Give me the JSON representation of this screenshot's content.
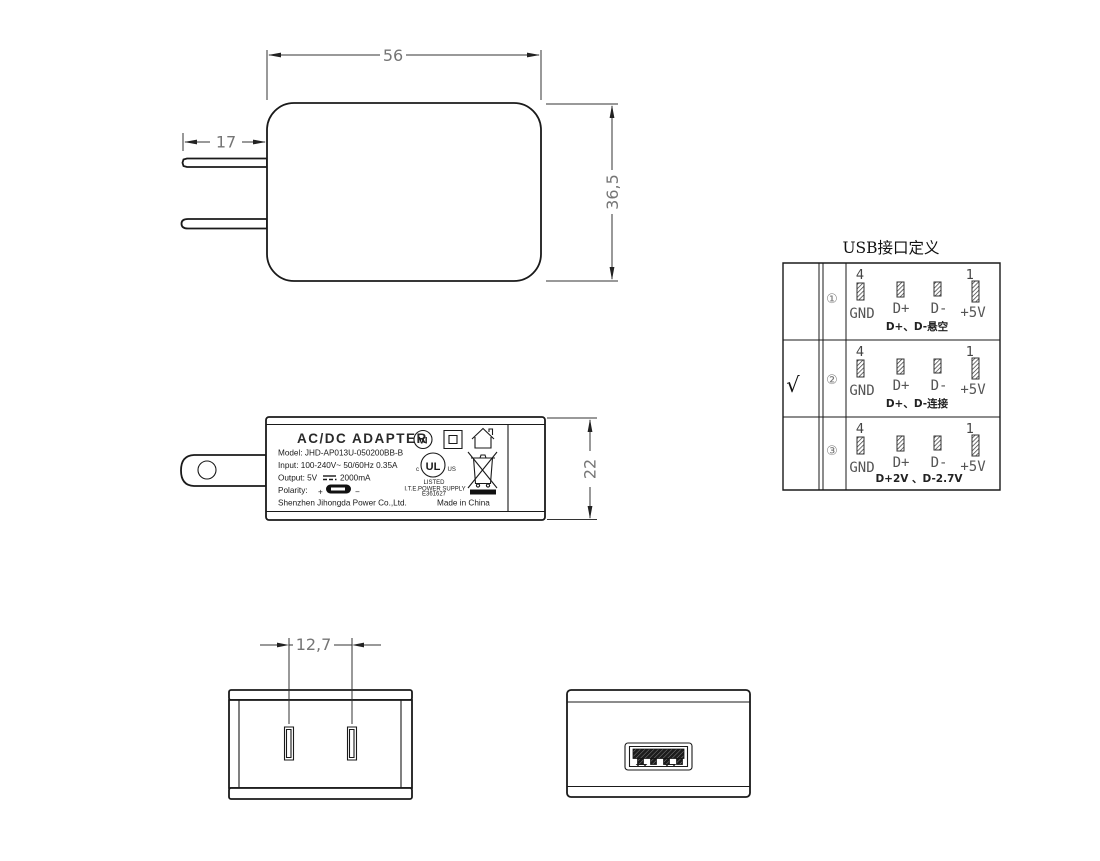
{
  "front_view": {
    "dim_width": "56",
    "dim_height": "36,5",
    "dim_prong": "17"
  },
  "side_view": {
    "dim_thickness": "22",
    "label": {
      "title": "AC/DC  ADAPTER",
      "model": "Model: JHD-AP013U-050200BB-B",
      "input": "Input: 100-240V~  50/60Hz  0.35A",
      "output_left": "Output: 5V",
      "output_right": "2000mA",
      "polarity": "Polarity:",
      "polarity_plus": "+",
      "polarity_minus": "−",
      "manufacturer": "Shenzhen Jihongda Power Co.,Ltd.",
      "made_in": "Made in China",
      "efficiency": "VI",
      "ul_mark": "UL",
      "ul_c": "c",
      "ul_us": "US",
      "ul_listed": "LISTED",
      "ul_line": "I.T.E.POWER SUPPLY",
      "ul_file": "E361627"
    }
  },
  "bottom_view": {
    "dim_pitch": "12,7"
  },
  "usb_table": {
    "title": "USB接口定义",
    "pin_top_left": "4",
    "pin_top_right": "1",
    "pin_labels": [
      "GND",
      "D+",
      "D-",
      "+5V"
    ],
    "rows": [
      {
        "index": "①",
        "check": "",
        "note": "D+、D-悬空"
      },
      {
        "index": "②",
        "check": "√",
        "note": "D+、D-连接"
      },
      {
        "index": "③",
        "check": "",
        "note": "D+2V 、D-2.7V"
      }
    ]
  }
}
